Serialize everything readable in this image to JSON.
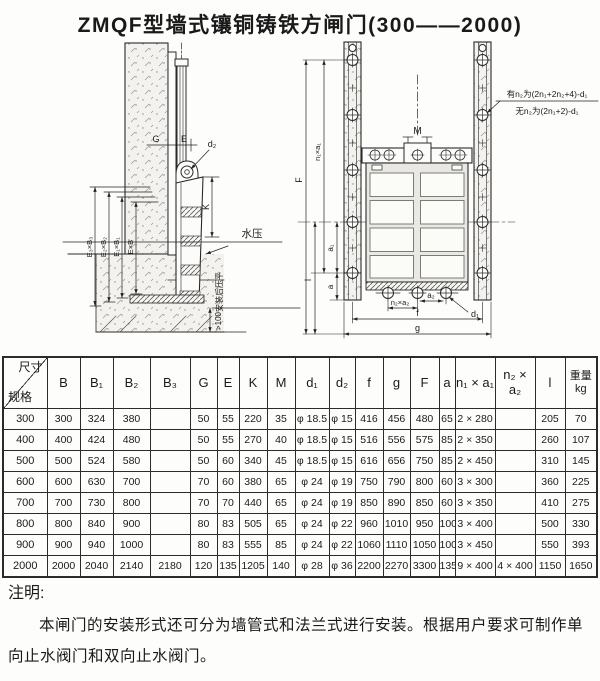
{
  "title": "ZMQF型墙式镶铜铸铁方闸门(300——2000)",
  "drawings": {
    "side_view": {
      "dim_g": "G",
      "dim_e": "E",
      "dim_d2": "d₂",
      "dim_k": "K",
      "water_pressure": "水压",
      "dim_e3b3": "E₃×B₃",
      "dim_e2b2": "E₂×B₂",
      "dim_e1b1": "E₁×B₁",
      "dim_eb": "E×B",
      "flatten_note": "安装后压平",
      "min_depth": ">100"
    },
    "front_view": {
      "dim_f_height": "F",
      "dim_n1a1": "n₁×a₁",
      "dim_l": "l",
      "dim_a1": "a₁",
      "dim_a": "a",
      "dim_m": "M",
      "dim_d1": "d₁",
      "dim_n2a2": "n₂×a₂",
      "dim_a2": "a₂",
      "dim_f_width": "f",
      "dim_g_width": "g",
      "bolt_note_line1": "有n₂为(2n₁+2n₂+4)-d₁",
      "bolt_note_line2": "无n₂为(2n₁+2)-d₁"
    }
  },
  "table": {
    "corner_top": "尺寸",
    "corner_bottom": "规格",
    "headers": [
      "B",
      "B₁",
      "B₂",
      "B₃",
      "G",
      "E",
      "K",
      "M",
      "d₁",
      "d₂",
      "f",
      "g",
      "F",
      "a",
      "n₁ × a₁",
      "n₂ × a₂",
      "l",
      "重量\nkg"
    ],
    "rows": [
      [
        "300",
        "300",
        "324",
        "380",
        "",
        "50",
        "55",
        "220",
        "35",
        "φ 18.5",
        "φ 15",
        "416",
        "456",
        "480",
        "65",
        "2 × 280",
        "",
        "205",
        "70"
      ],
      [
        "400",
        "400",
        "424",
        "480",
        "",
        "50",
        "55",
        "270",
        "40",
        "φ 18.5",
        "φ 15",
        "516",
        "556",
        "575",
        "85",
        "2 × 350",
        "",
        "260",
        "107"
      ],
      [
        "500",
        "500",
        "524",
        "580",
        "",
        "50",
        "60",
        "340",
        "45",
        "φ 18.5",
        "φ 15",
        "616",
        "656",
        "750",
        "85",
        "2 × 450",
        "",
        "310",
        "145"
      ],
      [
        "600",
        "600",
        "630",
        "700",
        "",
        "70",
        "60",
        "380",
        "65",
        "φ 24",
        "φ 19",
        "750",
        "790",
        "800",
        "60",
        "3 × 300",
        "",
        "360",
        "225"
      ],
      [
        "700",
        "700",
        "730",
        "800",
        "",
        "70",
        "70",
        "440",
        "65",
        "φ 24",
        "φ 19",
        "850",
        "890",
        "850",
        "60",
        "3 × 350",
        "",
        "410",
        "275"
      ],
      [
        "800",
        "800",
        "840",
        "900",
        "",
        "80",
        "83",
        "505",
        "65",
        "φ 24",
        "φ 22",
        "960",
        "1010",
        "950",
        "100",
        "3 × 400",
        "",
        "500",
        "330"
      ],
      [
        "900",
        "900",
        "940",
        "1000",
        "",
        "80",
        "83",
        "555",
        "85",
        "φ 24",
        "φ 22",
        "1060",
        "1110",
        "1050",
        "100",
        "3 × 450",
        "",
        "550",
        "393"
      ],
      [
        "2000",
        "2000",
        "2040",
        "2140",
        "2180",
        "120",
        "135",
        "1205",
        "140",
        "φ 28",
        "φ 36",
        "2200",
        "2270",
        "3300",
        "135",
        "9 × 400",
        "4 × 400",
        "1150",
        "1650"
      ]
    ]
  },
  "notes": {
    "heading": "注明:",
    "body": "本闸门的安装形式还可分为墙管式和法兰式进行安装。根据用户要求可制作单向止水阀门和双向止水阀门。"
  }
}
